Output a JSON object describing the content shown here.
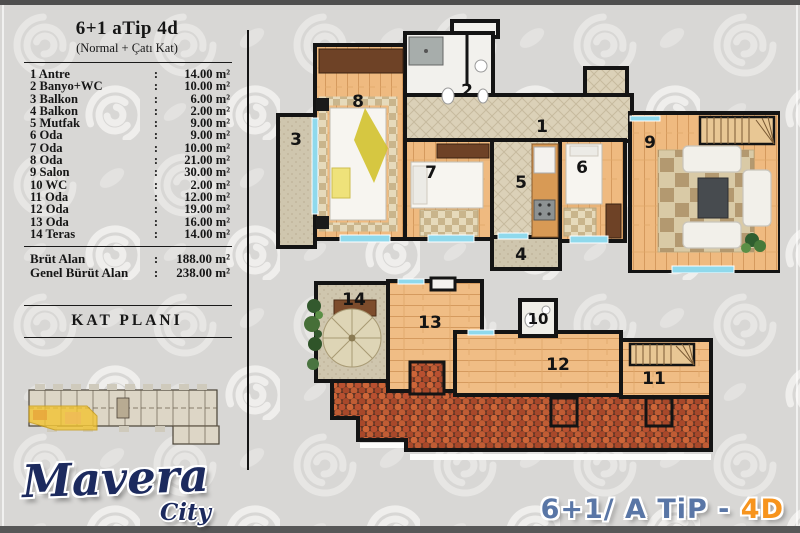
{
  "panel": {
    "title": "6+1 aTip 4d",
    "subtitle": "(Normal + Çatı Kat)",
    "separator": ":",
    "rooms": [
      {
        "label": "1 Antre",
        "value": "14.00 m²"
      },
      {
        "label": "2 Banyo+WC",
        "value": "10.00 m²"
      },
      {
        "label": "3 Balkon",
        "value": "6.00 m²"
      },
      {
        "label": "4 Balkon",
        "value": "2.00 m²"
      },
      {
        "label": "5 Mutfak",
        "value": "9.00 m²"
      },
      {
        "label": "6 Oda",
        "value": "9.00 m²"
      },
      {
        "label": "7 Oda",
        "value": "10.00 m²"
      },
      {
        "label": "8 Oda",
        "value": "21.00 m²"
      },
      {
        "label": "9 Salon",
        "value": "30.00 m²"
      },
      {
        "label": "10 WC",
        "value": "2.00 m²"
      },
      {
        "label": "11 Oda",
        "value": "12.00 m²"
      },
      {
        "label": "12 Oda",
        "value": "19.00 m²"
      },
      {
        "label": "13 Oda",
        "value": "16.00 m²"
      },
      {
        "label": "14 Teras",
        "value": "14.00 m²"
      }
    ],
    "totals": [
      {
        "label": "Brüt Alan",
        "value": "188.00 m²"
      },
      {
        "label": "Genel Bürüt Alan",
        "value": "238.00 m²"
      }
    ],
    "section_heading": "KAT PLANI"
  },
  "plan_labels": {
    "upper": [
      "3",
      "8",
      "2",
      "1",
      "7",
      "5",
      "4",
      "6",
      "9"
    ],
    "lower": [
      "14",
      "13",
      "10",
      "12",
      "11"
    ]
  },
  "footer": {
    "logo_main": "Mavera",
    "logo_sub": "City",
    "type_prefix": "6+1/ A TiP - ",
    "type_suffix": "4D"
  },
  "colors": {
    "accent_orange": "#f7941d",
    "type_title_blue": "#5976a6",
    "logo_navy": "#1c2a5e",
    "wall_black": "#141414",
    "wood": "#efba80",
    "roof_tile": "#c05c34",
    "highlight_unit_yellow": "#f3c42e"
  }
}
